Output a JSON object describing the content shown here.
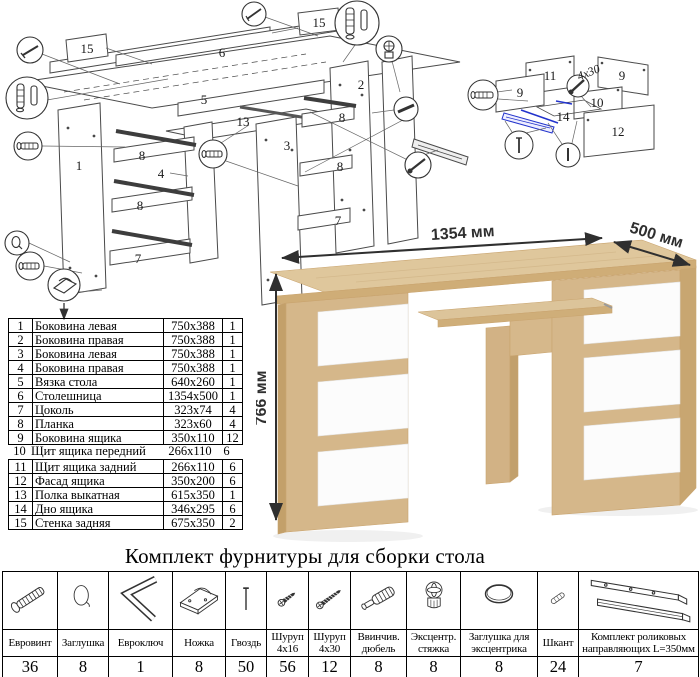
{
  "diagram_main": {
    "labels": [
      "15",
      "15",
      "6",
      "5",
      "13",
      "1",
      "4",
      "8",
      "8",
      "7",
      "2",
      "3",
      "8",
      "8",
      "7"
    ],
    "callout_icons": [
      "nail-icon",
      "dowel-pair-icon",
      "euroscrew-icon",
      "cap-icon",
      "euroscrew-icon",
      "foot-icon",
      "nail-icon",
      "dowel-pair-icon",
      "cam-icon",
      "euroscrew-icon",
      "rail-end-icon",
      "screw-icon"
    ]
  },
  "diagram_drawer": {
    "labels": [
      "11",
      "9",
      "9",
      "10",
      "14",
      "12"
    ],
    "screw_note": "4x30",
    "callout_icons": [
      "euroscrew-icon",
      "screw-icon",
      "nail-icon",
      "pin-icon"
    ]
  },
  "desk": {
    "width_label": "1354 мм",
    "depth_label": "500 мм",
    "height_label": "766 мм",
    "colors": {
      "wood": "#d9be93",
      "wood_dark": "#cba873",
      "wood_edge": "#c9a46f",
      "drawer": "#fcfcfc"
    }
  },
  "parts_table": {
    "rows": [
      {
        "num": "1",
        "name": "Боковина левая",
        "size": "750x388",
        "qty": "1"
      },
      {
        "num": "2",
        "name": "Боковина правая",
        "size": "750x388",
        "qty": "1"
      },
      {
        "num": "3",
        "name": "Боковина левая",
        "size": "750x388",
        "qty": "1"
      },
      {
        "num": "4",
        "name": "Боковина правая",
        "size": "750x388",
        "qty": "1"
      },
      {
        "num": "5",
        "name": "Вязка стола",
        "size": "640x260",
        "qty": "1"
      },
      {
        "num": "6",
        "name": "Столешница",
        "size": "1354x500",
        "qty": "1"
      },
      {
        "num": "7",
        "name": "Цоколь",
        "size": "323x74",
        "qty": "4"
      },
      {
        "num": "8",
        "name": "Планка",
        "size": "323x60",
        "qty": "4"
      },
      {
        "num": "9",
        "name": "Боковина ящика",
        "size": "350x110",
        "qty": "12"
      },
      {
        "num": "10",
        "name": "Щит ящика передний",
        "size": "266x110",
        "qty": "6"
      },
      {
        "num": "11",
        "name": "Щит ящика задний",
        "size": "266x110",
        "qty": "6"
      },
      {
        "num": "12",
        "name": "Фасад ящика",
        "size": "350x200",
        "qty": "6"
      },
      {
        "num": "13",
        "name": "Полка выкатная",
        "size": "615x350",
        "qty": "1"
      },
      {
        "num": "14",
        "name": "Дно ящика",
        "size": "346x295",
        "qty": "6"
      },
      {
        "num": "15",
        "name": "Стенка задняя",
        "size": "675x350",
        "qty": "2"
      }
    ]
  },
  "hardware": {
    "title": "Комплект фурнитуры для сборки стола",
    "items": [
      {
        "name": "Евровинт",
        "qty": "36",
        "icon": "euroscrew-icon"
      },
      {
        "name": "Заглушка",
        "qty": "8",
        "icon": "cap-icon"
      },
      {
        "name": "Евроключ",
        "qty": "1",
        "icon": "hexkey-icon"
      },
      {
        "name": "Ножка",
        "qty": "8",
        "icon": "foot-icon"
      },
      {
        "name": "Гвоздь",
        "qty": "50",
        "icon": "nail-icon"
      },
      {
        "name": "Шуруп 4x16",
        "qty": "56",
        "icon": "screw-short-icon"
      },
      {
        "name": "Шуруп 4x30",
        "qty": "12",
        "icon": "screw-long-icon"
      },
      {
        "name": "Ввинчив. дюбель",
        "qty": "8",
        "icon": "dowel-screw-icon"
      },
      {
        "name": "Эксцентр. стяжка",
        "qty": "8",
        "icon": "cam-lock-icon"
      },
      {
        "name": "Заглушка для эксцентрика",
        "qty": "8",
        "icon": "cam-cap-icon"
      },
      {
        "name": "Шкант",
        "qty": "24",
        "icon": "wood-dowel-icon"
      },
      {
        "name": "Комплект роликовых направляющих L=350мм",
        "qty": "7",
        "icon": "roller-rails-icon"
      }
    ]
  }
}
